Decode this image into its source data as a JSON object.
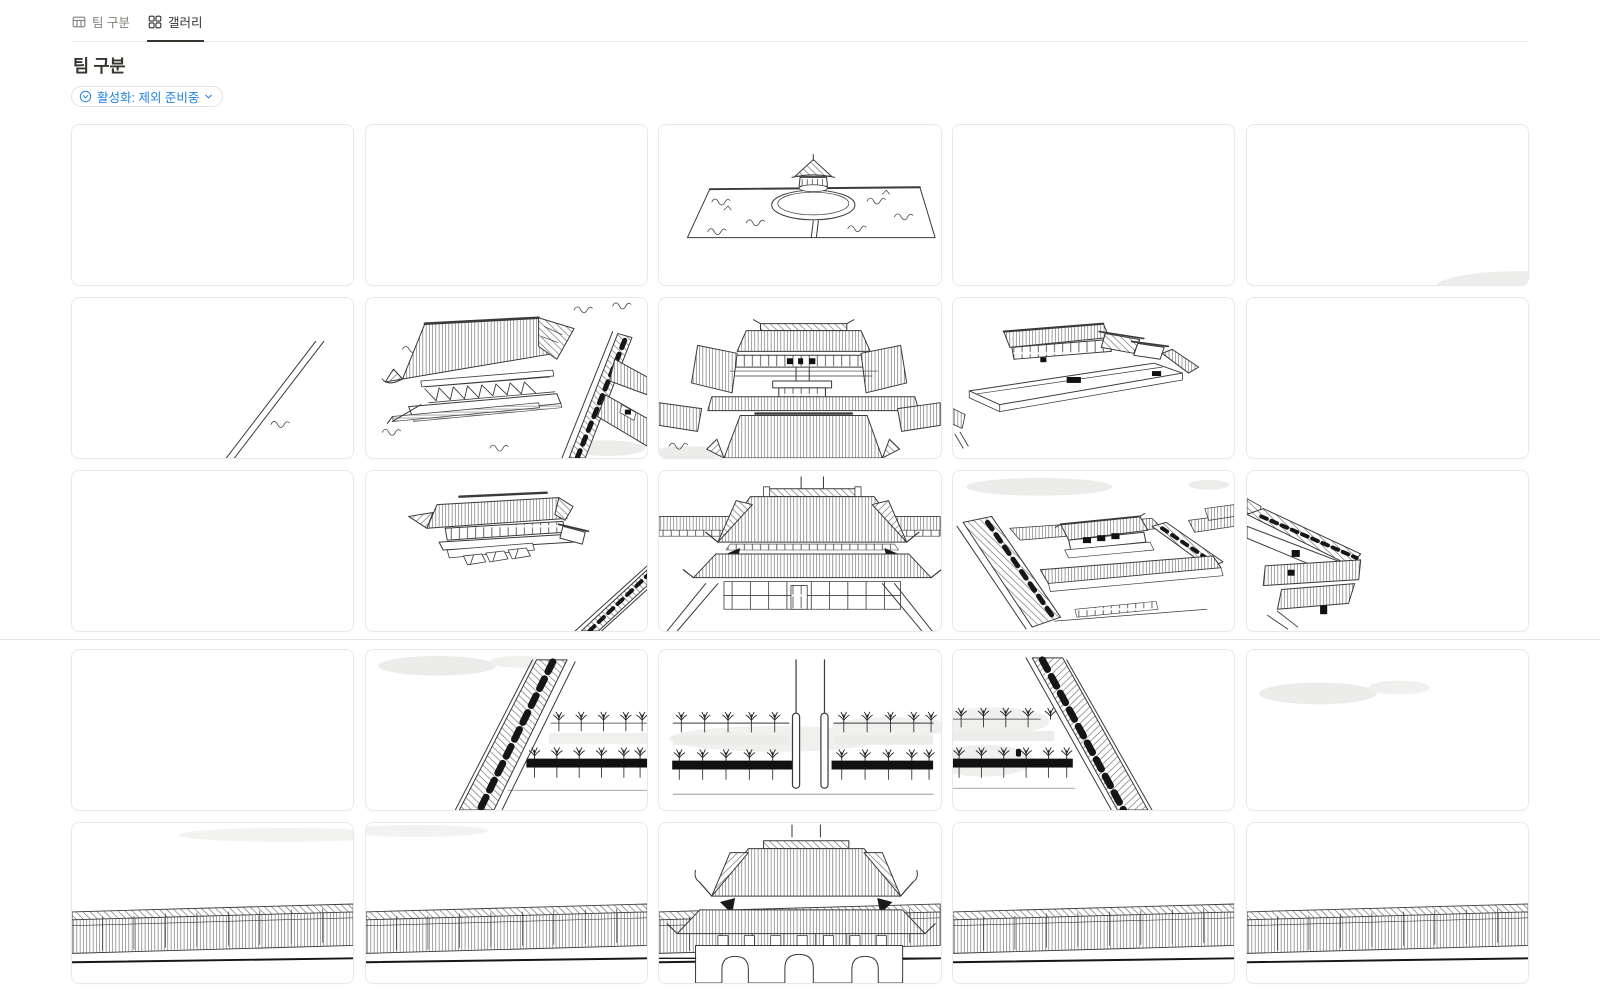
{
  "view_tabs": [
    {
      "label": "팀 구분",
      "icon": "table-icon",
      "active": false
    },
    {
      "label": "갤러리",
      "icon": "gallery-icon",
      "active": true
    }
  ],
  "page": {
    "title": "팀 구분"
  },
  "filter": {
    "label": "활성화: 제외 준비중",
    "icon": "filter-circle-icon",
    "chevron": "chevron-down-icon"
  },
  "colors": {
    "accent_blue": "#2383e2",
    "tab_active": "#33322f",
    "tab_inactive": "#82807b",
    "card_border": "#e9e9e7",
    "tab_border": "#ebebea",
    "divider": "#e8e7e5",
    "sketch_ink": "#3a3a3a",
    "cloud_gray": "#ececeb"
  },
  "gallery": {
    "rows": 5,
    "cols": 5,
    "cards": [
      {
        "sketch": "empty",
        "alt": "empty tile"
      },
      {
        "sketch": "empty",
        "alt": "empty tile"
      },
      {
        "sketch": "pond-pavilion",
        "alt": "pond with island pavilion"
      },
      {
        "sketch": "empty",
        "alt": "empty tile"
      },
      {
        "sketch": "cloud-corner",
        "alt": "cloud shading"
      },
      {
        "sketch": "pond-edge",
        "alt": "pond edge"
      },
      {
        "sketch": "pavilion-hall",
        "alt": "large pavilion hall"
      },
      {
        "sketch": "central-halls",
        "alt": "central palace halls"
      },
      {
        "sketch": "walled-compound",
        "alt": "walled compound"
      },
      {
        "sketch": "empty",
        "alt": "empty tile"
      },
      {
        "sketch": "empty",
        "alt": "empty tile"
      },
      {
        "sketch": "hall-with-steps",
        "alt": "palace hall with steps"
      },
      {
        "sketch": "inner-gate",
        "alt": "inner gate"
      },
      {
        "sketch": "walled-compounds",
        "alt": "walled compounds"
      },
      {
        "sketch": "corridor-roofs",
        "alt": "corridor roofs"
      },
      {
        "sketch": "empty",
        "alt": "empty tile"
      },
      {
        "sketch": "west-wall-trees",
        "alt": "west wall and tree rows"
      },
      {
        "sketch": "forecourt-trees",
        "alt": "forecourt trees and flagpoles"
      },
      {
        "sketch": "east-wall-trees",
        "alt": "east wall and tree rows"
      },
      {
        "sketch": "cloud-top",
        "alt": "cloud shading"
      },
      {
        "sketch": "outer-wall",
        "alt": "outer wall"
      },
      {
        "sketch": "outer-wall",
        "alt": "outer wall"
      },
      {
        "sketch": "main-gate",
        "alt": "main gate"
      },
      {
        "sketch": "outer-wall",
        "alt": "outer wall"
      },
      {
        "sketch": "outer-wall",
        "alt": "outer wall"
      }
    ]
  }
}
